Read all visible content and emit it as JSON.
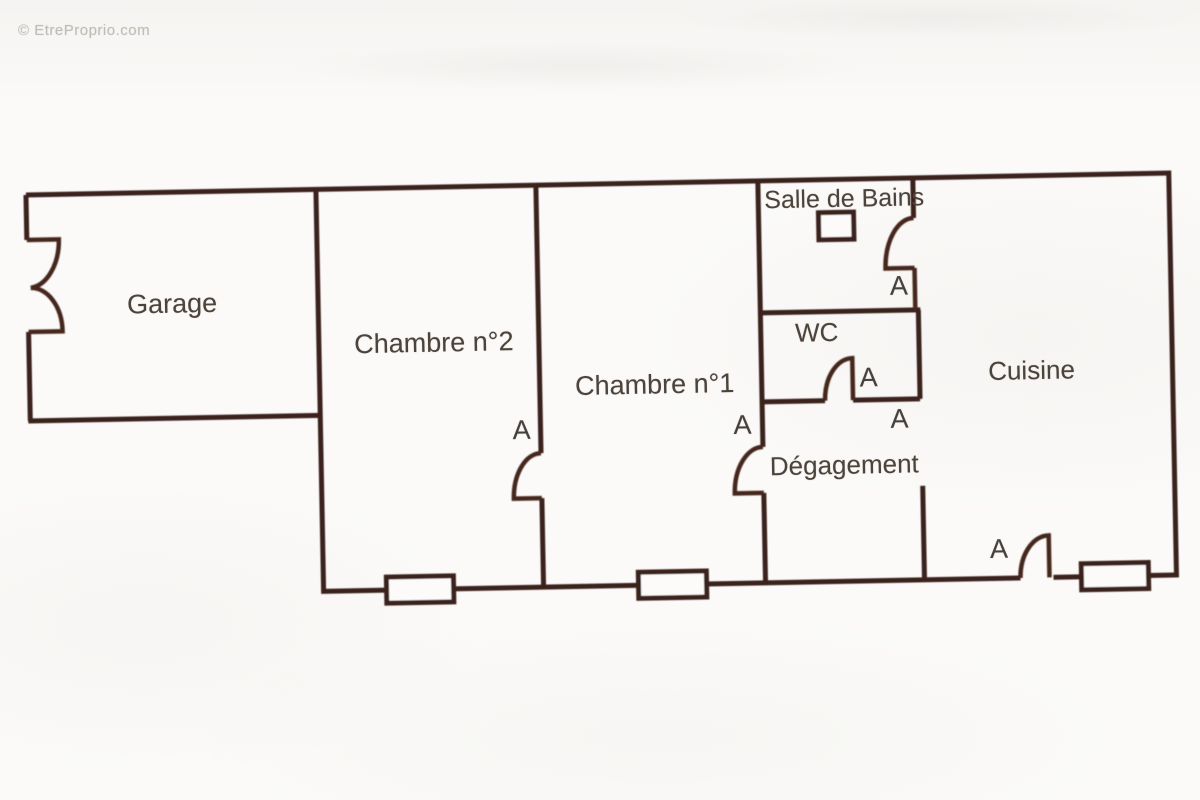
{
  "watermark": {
    "text": "© EtreProprio.com"
  },
  "floor_plan": {
    "type": "apartment-floor-plan-scan",
    "rooms": [
      {
        "id": "garage",
        "label": "Garage"
      },
      {
        "id": "chambre-2",
        "label": "Chambre n°2"
      },
      {
        "id": "chambre-1",
        "label": "Chambre n°1"
      },
      {
        "id": "salle-de-bains",
        "label": "Salle de Bains"
      },
      {
        "id": "wc",
        "label": "WC"
      },
      {
        "id": "degagement",
        "label": "Dégagement"
      },
      {
        "id": "cuisine",
        "label": "Cuisine"
      }
    ],
    "door_labels": [
      {
        "door": "chambre-2-door",
        "label": "A"
      },
      {
        "door": "chambre-1-door",
        "label": "A"
      },
      {
        "door": "salle-de-bains-door",
        "label": "A"
      },
      {
        "door": "wc-door",
        "label": "A"
      },
      {
        "door": "degagement-cuisine-opening",
        "label": "A"
      },
      {
        "door": "cuisine-exterior-door",
        "label": "A"
      }
    ],
    "colors": {
      "wall": "#3a221a",
      "door_arc": "#45251c",
      "label_text": "#4c433b",
      "paper": "#fbfaf8",
      "watermark_text": "#acaaa4"
    }
  }
}
